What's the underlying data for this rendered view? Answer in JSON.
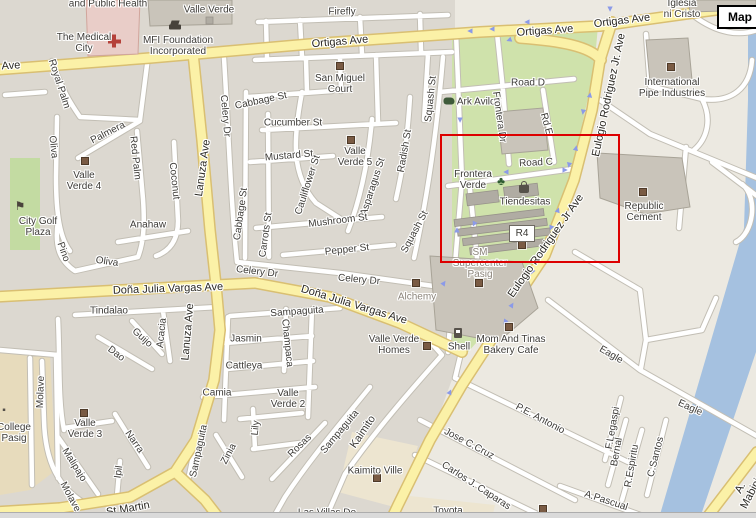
{
  "map": {
    "controls": {
      "map_button": "Map"
    },
    "r4_label": "R4",
    "highlight_rectangle": {
      "x": 440,
      "y": 134,
      "w": 176,
      "h": 125
    },
    "colors": {
      "land": "#ece9e1",
      "block": "#dcd8d0",
      "park": "#cfe2ab",
      "golf": "#c3dba2",
      "water": "#a5c1e0",
      "tan": "#e7dbbc",
      "tan_light": "#ede5d0",
      "road_casing": "#c2beb4",
      "yellow": "#fbf1a7",
      "yellow_casing": "#d9bf72",
      "building": "#c9c4ba",
      "building_stroke": "#a8a397",
      "building_dark": "#b0aca3",
      "pink_building": "#e9cdc8",
      "pink_stroke": "#d1a59c",
      "highlight_red": "#dd0000",
      "marker_brown": "#7a5b44",
      "arrow_blue": "#8b9ae8",
      "label_dark": "#3d3b37",
      "label_gray": "#8b847a",
      "road_label": "#2a2822"
    },
    "labels": [
      {
        "t": "and Public Health",
        "x": 108,
        "y": 4
      },
      {
        "t": "Valle Verde",
        "x": 209,
        "y": 10
      },
      {
        "t": "The Medical\nCity",
        "x": 84,
        "y": 43
      },
      {
        "t": "MFI Foundation\nIncorporated",
        "x": 178,
        "y": 46
      },
      {
        "t": "Firefly",
        "x": 342,
        "y": 12
      },
      {
        "t": "Ave",
        "x": 11,
        "y": 66,
        "r": -3,
        "c": "rd"
      },
      {
        "t": "Ortigas Ave",
        "x": 340,
        "y": 42,
        "r": -5,
        "c": "rd"
      },
      {
        "t": "Ortigas Ave",
        "x": 545,
        "y": 31,
        "r": -4,
        "c": "rd"
      },
      {
        "t": "Ortigas Ave",
        "x": 622,
        "y": 21,
        "r": -7,
        "c": "rd"
      },
      {
        "t": "Iglesia\nni Cristo",
        "x": 682,
        "y": 9
      },
      {
        "t": "International\nPipe Industries",
        "x": 672,
        "y": 88
      },
      {
        "t": "San Miguel\nCourt",
        "x": 340,
        "y": 84
      },
      {
        "t": "Road D",
        "x": 528,
        "y": 83
      },
      {
        "t": "Ark Avilon",
        "x": 479,
        "y": 102
      },
      {
        "t": "Frontera Dr",
        "x": 499,
        "y": 117,
        "r": 82
      },
      {
        "t": "Rd E",
        "x": 546,
        "y": 124,
        "r": 75
      },
      {
        "t": "Road C",
        "x": 536,
        "y": 163,
        "r": -3
      },
      {
        "t": "Frontera\nVerde",
        "x": 473,
        "y": 180
      },
      {
        "t": "Eulogio Rodriguez Jr. Ave",
        "x": 609,
        "y": 95,
        "r": -78,
        "c": "rd"
      },
      {
        "t": "Eulogio Rodriguez Jr Ave",
        "x": 546,
        "y": 246,
        "r": -55,
        "c": "rd"
      },
      {
        "t": "Tiendesitas",
        "x": 525,
        "y": 202
      },
      {
        "t": "SM\nSupercenter\nPasig",
        "x": 480,
        "y": 264,
        "c": "gy"
      },
      {
        "t": "Republic\nCement",
        "x": 644,
        "y": 212
      },
      {
        "t": "Cabbage St",
        "x": 261,
        "y": 101,
        "r": -12
      },
      {
        "t": "Cucumber St",
        "x": 293,
        "y": 123
      },
      {
        "t": "Mustard St",
        "x": 289,
        "y": 156,
        "r": -5
      },
      {
        "t": "Valle\nVerde 5",
        "x": 355,
        "y": 157
      },
      {
        "t": "Cauliflower St",
        "x": 308,
        "y": 185,
        "r": -72
      },
      {
        "t": "Asparagus St",
        "x": 373,
        "y": 187,
        "r": -72
      },
      {
        "t": "Radish St",
        "x": 405,
        "y": 151,
        "r": -80
      },
      {
        "t": "Squash St",
        "x": 431,
        "y": 99,
        "r": -84
      },
      {
        "t": "Squash St",
        "x": 415,
        "y": 232,
        "r": -62
      },
      {
        "t": "Mushroom St",
        "x": 338,
        "y": 221,
        "r": -7
      },
      {
        "t": "Pepper St",
        "x": 347,
        "y": 250,
        "r": -6
      },
      {
        "t": "Celery Dr",
        "x": 225,
        "y": 116,
        "r": 85
      },
      {
        "t": "Celery Dr",
        "x": 257,
        "y": 272,
        "r": 7
      },
      {
        "t": "Celery Dr",
        "x": 359,
        "y": 280,
        "r": 5
      },
      {
        "t": "Cabbage St",
        "x": 241,
        "y": 214,
        "r": -82
      },
      {
        "t": "Carrots St",
        "x": 266,
        "y": 235,
        "r": -82
      },
      {
        "t": "Royal Palm",
        "x": 59,
        "y": 84,
        "r": 72
      },
      {
        "t": "Palmera",
        "x": 108,
        "y": 133,
        "r": -27
      },
      {
        "t": "Red Palm",
        "x": 135,
        "y": 158,
        "r": 84
      },
      {
        "t": "Coconut",
        "x": 174,
        "y": 181,
        "r": 84
      },
      {
        "t": "Lanuza Ave",
        "x": 203,
        "y": 168,
        "r": -82,
        "c": "rd"
      },
      {
        "t": "Lanuza Ave",
        "x": 188,
        "y": 332,
        "r": -85,
        "c": "rd"
      },
      {
        "t": "Valle\nVerde 4",
        "x": 84,
        "y": 181
      },
      {
        "t": "Oliva",
        "x": 53,
        "y": 147,
        "r": 84
      },
      {
        "t": "Anahaw",
        "x": 148,
        "y": 225
      },
      {
        "t": "Pino",
        "x": 63,
        "y": 252,
        "r": 70
      },
      {
        "t": "Oliva",
        "x": 107,
        "y": 262,
        "r": 8
      },
      {
        "t": "City Golf\nPlaza",
        "x": 38,
        "y": 227
      },
      {
        "t": "Doña Julia Vargas Ave",
        "x": 168,
        "y": 289,
        "r": -2,
        "c": "rd"
      },
      {
        "t": "Doña Julia Vargas Ave",
        "x": 354,
        "y": 305,
        "r": 17,
        "c": "rd"
      },
      {
        "t": "Tindalao",
        "x": 109,
        "y": 311
      },
      {
        "t": "Guijo",
        "x": 142,
        "y": 338,
        "r": 42
      },
      {
        "t": "Acacia",
        "x": 162,
        "y": 333,
        "r": -84
      },
      {
        "t": "Dao",
        "x": 116,
        "y": 354,
        "r": 37
      },
      {
        "t": "Molave",
        "x": 41,
        "y": 392,
        "r": -88
      },
      {
        "t": "Molave",
        "x": 70,
        "y": 497,
        "r": 62
      },
      {
        "t": "College\nPasig",
        "x": 14,
        "y": 433
      },
      {
        "t": "Valle\nVerde 3",
        "x": 85,
        "y": 429
      },
      {
        "t": "Malipajo",
        "x": 74,
        "y": 465,
        "r": 58
      },
      {
        "t": "Narra",
        "x": 134,
        "y": 442,
        "r": 55
      },
      {
        "t": "Ipil",
        "x": 119,
        "y": 472,
        "r": -82
      },
      {
        "t": "St Martin",
        "x": 128,
        "y": 509,
        "r": -10,
        "c": "rd"
      },
      {
        "t": "Jasmin",
        "x": 246,
        "y": 339
      },
      {
        "t": "Cattleya",
        "x": 244,
        "y": 366
      },
      {
        "t": "Camia",
        "x": 217,
        "y": 393
      },
      {
        "t": "Sampaguita",
        "x": 297,
        "y": 312,
        "r": -4
      },
      {
        "t": "Champaca",
        "x": 287,
        "y": 343,
        "r": 84
      },
      {
        "t": "Valle\nVerde 2",
        "x": 288,
        "y": 399
      },
      {
        "t": "Lily",
        "x": 256,
        "y": 428,
        "r": -84
      },
      {
        "t": "Zinia",
        "x": 229,
        "y": 454,
        "r": -62
      },
      {
        "t": "Rosas",
        "x": 300,
        "y": 446,
        "r": -44
      },
      {
        "t": "Sampaguita",
        "x": 199,
        "y": 451,
        "r": -78
      },
      {
        "t": "Sampaguita",
        "x": 340,
        "y": 432,
        "r": -50
      },
      {
        "t": "Kaimito",
        "x": 363,
        "y": 432,
        "r": -56,
        "c": "md"
      },
      {
        "t": "Kaimito Ville",
        "x": 375,
        "y": 471
      },
      {
        "t": "Las Villas De",
        "x": 327,
        "y": 513
      },
      {
        "t": "Toyota",
        "x": 448,
        "y": 511
      },
      {
        "t": "Alchemy",
        "x": 417,
        "y": 297,
        "c": "gy"
      },
      {
        "t": "Valle Verde\nHomes",
        "x": 394,
        "y": 345
      },
      {
        "t": "Shell",
        "x": 459,
        "y": 347
      },
      {
        "t": "Mom And Tinas\nBakery Cafe",
        "x": 511,
        "y": 345
      },
      {
        "t": "Eagle",
        "x": 611,
        "y": 355,
        "r": 30
      },
      {
        "t": "Eagle",
        "x": 690,
        "y": 408,
        "r": 24
      },
      {
        "t": "P.E. Antonio",
        "x": 540,
        "y": 419,
        "r": 28
      },
      {
        "t": "Jose C.Cruz",
        "x": 469,
        "y": 444,
        "r": 28
      },
      {
        "t": "Carlos J. Caparas",
        "x": 476,
        "y": 486,
        "r": 33
      },
      {
        "t": "F.Legaspi",
        "x": 613,
        "y": 428,
        "r": -80
      },
      {
        "t": "Bernal",
        "x": 617,
        "y": 452,
        "r": -80
      },
      {
        "t": "R.Espiritu",
        "x": 632,
        "y": 466,
        "r": -80
      },
      {
        "t": "C.Santos",
        "x": 656,
        "y": 457,
        "r": -76
      },
      {
        "t": "A.Pascual",
        "x": 606,
        "y": 501,
        "r": 18
      },
      {
        "t": "A. Mabini",
        "x": 746,
        "y": 491,
        "r": -62,
        "c": "rd"
      }
    ],
    "markers": [
      {
        "x": 340,
        "y": 66
      },
      {
        "x": 351,
        "y": 140
      },
      {
        "x": 85,
        "y": 161
      },
      {
        "x": 671,
        "y": 67
      },
      {
        "x": 643,
        "y": 192
      },
      {
        "x": 522,
        "y": 245
      },
      {
        "x": 479,
        "y": 283
      },
      {
        "x": 416,
        "y": 283
      },
      {
        "x": 427,
        "y": 346
      },
      {
        "x": 509,
        "y": 327
      },
      {
        "x": 84,
        "y": 413
      },
      {
        "x": 377,
        "y": 478
      },
      {
        "x": 543,
        "y": 509
      }
    ],
    "icons": [
      {
        "name": "hospital-cross-icon",
        "type": "cross",
        "x": 114,
        "y": 41
      },
      {
        "name": "graduation-cap-icon",
        "type": "cap",
        "x": 175,
        "y": 27
      },
      {
        "name": "golf-flag-icon",
        "type": "flag",
        "x": 20,
        "y": 206,
        "glyph": "⚑"
      },
      {
        "name": "ark-avilon-animal-icon",
        "type": "blob",
        "x": 449,
        "y": 101
      },
      {
        "name": "tree-icon",
        "type": "tree",
        "x": 501,
        "y": 181,
        "glyph": "♣"
      },
      {
        "name": "shopping-bag-icon",
        "type": "bag",
        "x": 524,
        "y": 189
      },
      {
        "name": "gas-pump-icon",
        "type": "pump",
        "x": 458,
        "y": 333
      },
      {
        "name": "college-icon",
        "type": "school",
        "x": 4,
        "y": 411,
        "glyph": "▪"
      }
    ],
    "arrows": [
      {
        "x": 470,
        "y": 31,
        "d": 270
      },
      {
        "x": 492,
        "y": 29,
        "d": 270
      },
      {
        "x": 509,
        "y": 40,
        "d": 250
      },
      {
        "x": 527,
        "y": 22,
        "d": 270
      },
      {
        "x": 610,
        "y": 9,
        "d": 180
      },
      {
        "x": 590,
        "y": 95,
        "d": 10
      },
      {
        "x": 583,
        "y": 112,
        "d": 190
      },
      {
        "x": 576,
        "y": 148,
        "d": 12
      },
      {
        "x": 569,
        "y": 165,
        "d": 192
      },
      {
        "x": 558,
        "y": 210,
        "d": 20
      },
      {
        "x": 551,
        "y": 228,
        "d": 200
      },
      {
        "x": 540,
        "y": 255,
        "d": 25
      },
      {
        "x": 532,
        "y": 272,
        "d": 205
      },
      {
        "x": 512,
        "y": 305,
        "d": 32
      },
      {
        "x": 505,
        "y": 322,
        "d": 212
      },
      {
        "x": 506,
        "y": 172,
        "d": 270
      },
      {
        "x": 565,
        "y": 170,
        "d": 90
      },
      {
        "x": 460,
        "y": 120,
        "d": 180
      },
      {
        "x": 457,
        "y": 230,
        "d": 0
      },
      {
        "x": 474,
        "y": 224,
        "d": 205
      },
      {
        "x": 444,
        "y": 283,
        "d": 35
      },
      {
        "x": 450,
        "y": 392,
        "d": 25
      }
    ]
  }
}
